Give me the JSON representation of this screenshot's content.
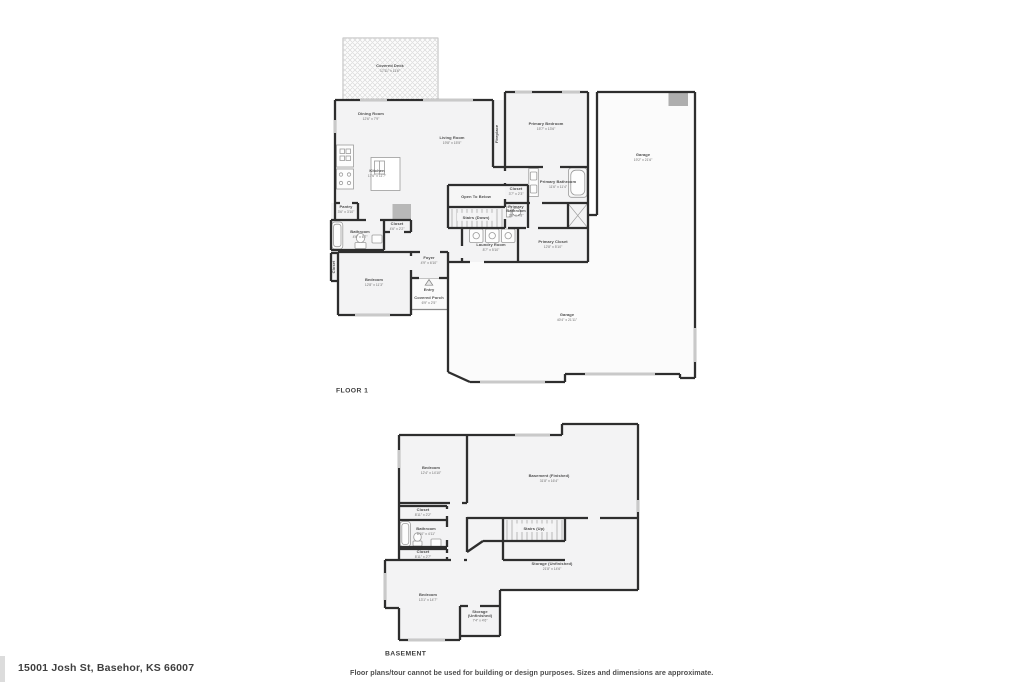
{
  "address": "15001 Josh St, Basehor, KS 66007",
  "disclaimer": "Floor plans/tour cannot be used for building or design purposes. Sizes and dimensions are approximate.",
  "palette": {
    "wall": "#2e2e2e",
    "window": "#c9c9c9",
    "room_fill": "#f3f3f4",
    "garage_fill": "#fbfbfb",
    "fixture_stroke": "#9b9b9b"
  },
  "floor1": {
    "title": "FLOOR 1",
    "rooms": [
      {
        "name": "Covered Deck",
        "dims": "17'11\" x 11'6\"",
        "x": 390,
        "y": 67
      },
      {
        "name": "Dining Room",
        "dims": "12'6\" x 7'9\"",
        "x": 371,
        "y": 115
      },
      {
        "name": "Living Room",
        "dims": "19'8\" x 15'5\"",
        "x": 452,
        "y": 139
      },
      {
        "name": "Kitchen",
        "dims": "17'6\" x 11'7\"",
        "x": 377,
        "y": 172
      },
      {
        "name": "Fireplace",
        "dims": "",
        "x": 498,
        "y": 134,
        "rotate": -90
      },
      {
        "name": "Primary Bedroom",
        "dims": "15'7\" x 13'6\"",
        "x": 546,
        "y": 125
      },
      {
        "name": "Garage",
        "dims": "19'2\" x 21'6\"",
        "x": 643,
        "y": 156
      },
      {
        "name": "Open To Below",
        "dims": "",
        "x": 476,
        "y": 198
      },
      {
        "name": "Closet",
        "dims": "3'7\" x 2'3\"",
        "x": 516,
        "y": 190
      },
      {
        "name": "Primary Bathroom",
        "dims": "11'6\" x 11'4\"",
        "x": 558,
        "y": 183
      },
      {
        "name": "Primary",
        "name2": "Bathroom",
        "dims": "3'8\" x 4'8\"",
        "x": 516,
        "y": 208
      },
      {
        "name": "Stairs (Down)",
        "dims": "",
        "x": 476,
        "y": 219
      },
      {
        "name": "Laundry Room",
        "dims": "8'7\" x 5'10\"",
        "x": 491,
        "y": 246
      },
      {
        "name": "Primary Closet",
        "dims": "12'8\" x 5'10\"",
        "x": 553,
        "y": 243
      },
      {
        "name": "Pantry",
        "dims": "3'6\" x 3'10\"",
        "x": 346,
        "y": 208
      },
      {
        "name": "Bathroom",
        "dims": "4'6\" x 6'7\"",
        "x": 360,
        "y": 233
      },
      {
        "name": "Closet",
        "dims": "4'6\" x 2'2\"",
        "x": 397,
        "y": 225
      },
      {
        "name": "Closet",
        "dims": "",
        "x": 335,
        "y": 267,
        "rotate": -90
      },
      {
        "name": "Bedroom",
        "dims": "12'8\" x 11'3\"",
        "x": 374,
        "y": 281
      },
      {
        "name": "Foyer",
        "dims": "4'9\" x 6'10\"",
        "x": 429,
        "y": 259
      },
      {
        "name": "Entry",
        "dims": "",
        "x": 429,
        "y": 291
      },
      {
        "name": "Covered Porch",
        "dims": "6'9\" x 2'5\"",
        "x": 429,
        "y": 299
      },
      {
        "name": "Garage",
        "dims": "40'4\" x 21'11\"",
        "x": 567,
        "y": 316
      }
    ]
  },
  "basement": {
    "title": "BASEMENT",
    "rooms": [
      {
        "name": "Bedroom",
        "dims": "12'4\" x 14'10\"",
        "x": 431,
        "y": 469
      },
      {
        "name": "Basement (Finished)",
        "dims": "31'8\" x 16'4\"",
        "x": 549,
        "y": 477
      },
      {
        "name": "Closet",
        "dims": "8'11\" x 2'2\"",
        "x": 423,
        "y": 511
      },
      {
        "name": "Bathroom",
        "dims": "8'10\" x 4'11\"",
        "x": 426,
        "y": 530
      },
      {
        "name": "Closet",
        "dims": "8'11\" x 2'7\"",
        "x": 423,
        "y": 553
      },
      {
        "name": "Stairs (Up)",
        "dims": "",
        "x": 534,
        "y": 530
      },
      {
        "name": "Storage (Unfinished)",
        "dims": "21'8\" x 14'6\"",
        "x": 552,
        "y": 565
      },
      {
        "name": "Bedroom",
        "dims": "13'1\" x 14'7\"",
        "x": 428,
        "y": 596
      },
      {
        "name": "Storage",
        "name2": "(Unfinished)",
        "dims": "7'4\" x 4'6\"",
        "x": 480,
        "y": 613
      }
    ]
  }
}
